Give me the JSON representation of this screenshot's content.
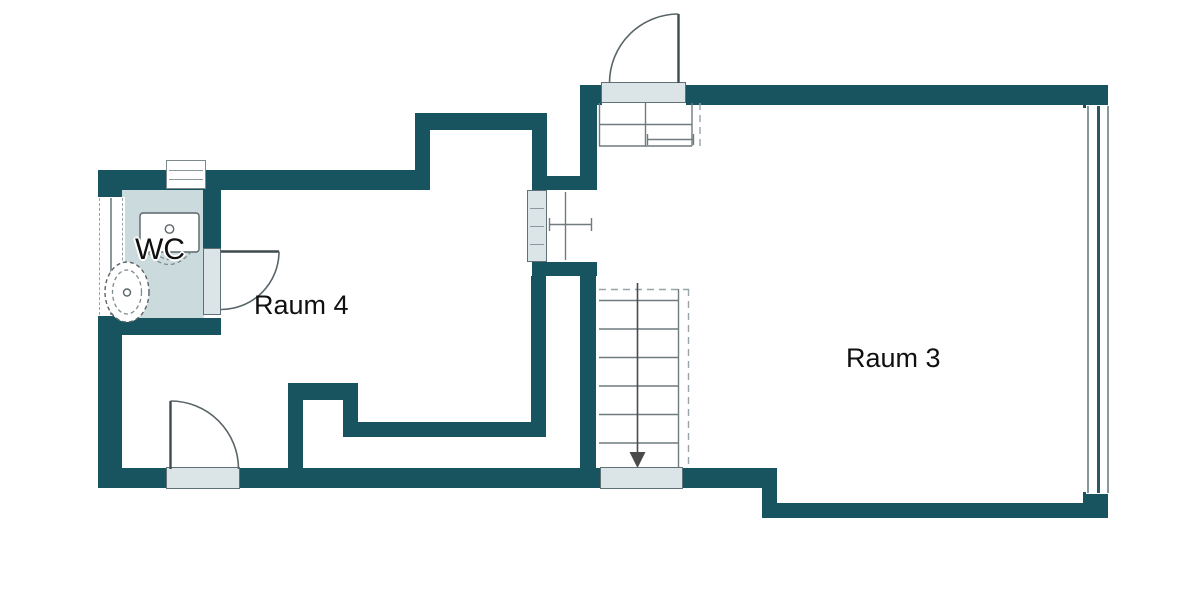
{
  "rooms": {
    "raum3": {
      "label": "Raum 3"
    },
    "raum4": {
      "label": "Raum 4"
    },
    "wc": {
      "label": "WC"
    }
  },
  "colors": {
    "wall": "#175460",
    "wc_floor": "#cadadd",
    "threshold": "#dbe5e7",
    "threshold_border": "#5f7077",
    "door_line": "#3f4a4e",
    "stair_line": "#6f7b7e",
    "dash": "#98a4a7",
    "fixture_line": "#5a6569",
    "window_line": "#8a979b",
    "window_line_dark": "#2c5660",
    "text": "#101010",
    "background": "#ffffff"
  }
}
